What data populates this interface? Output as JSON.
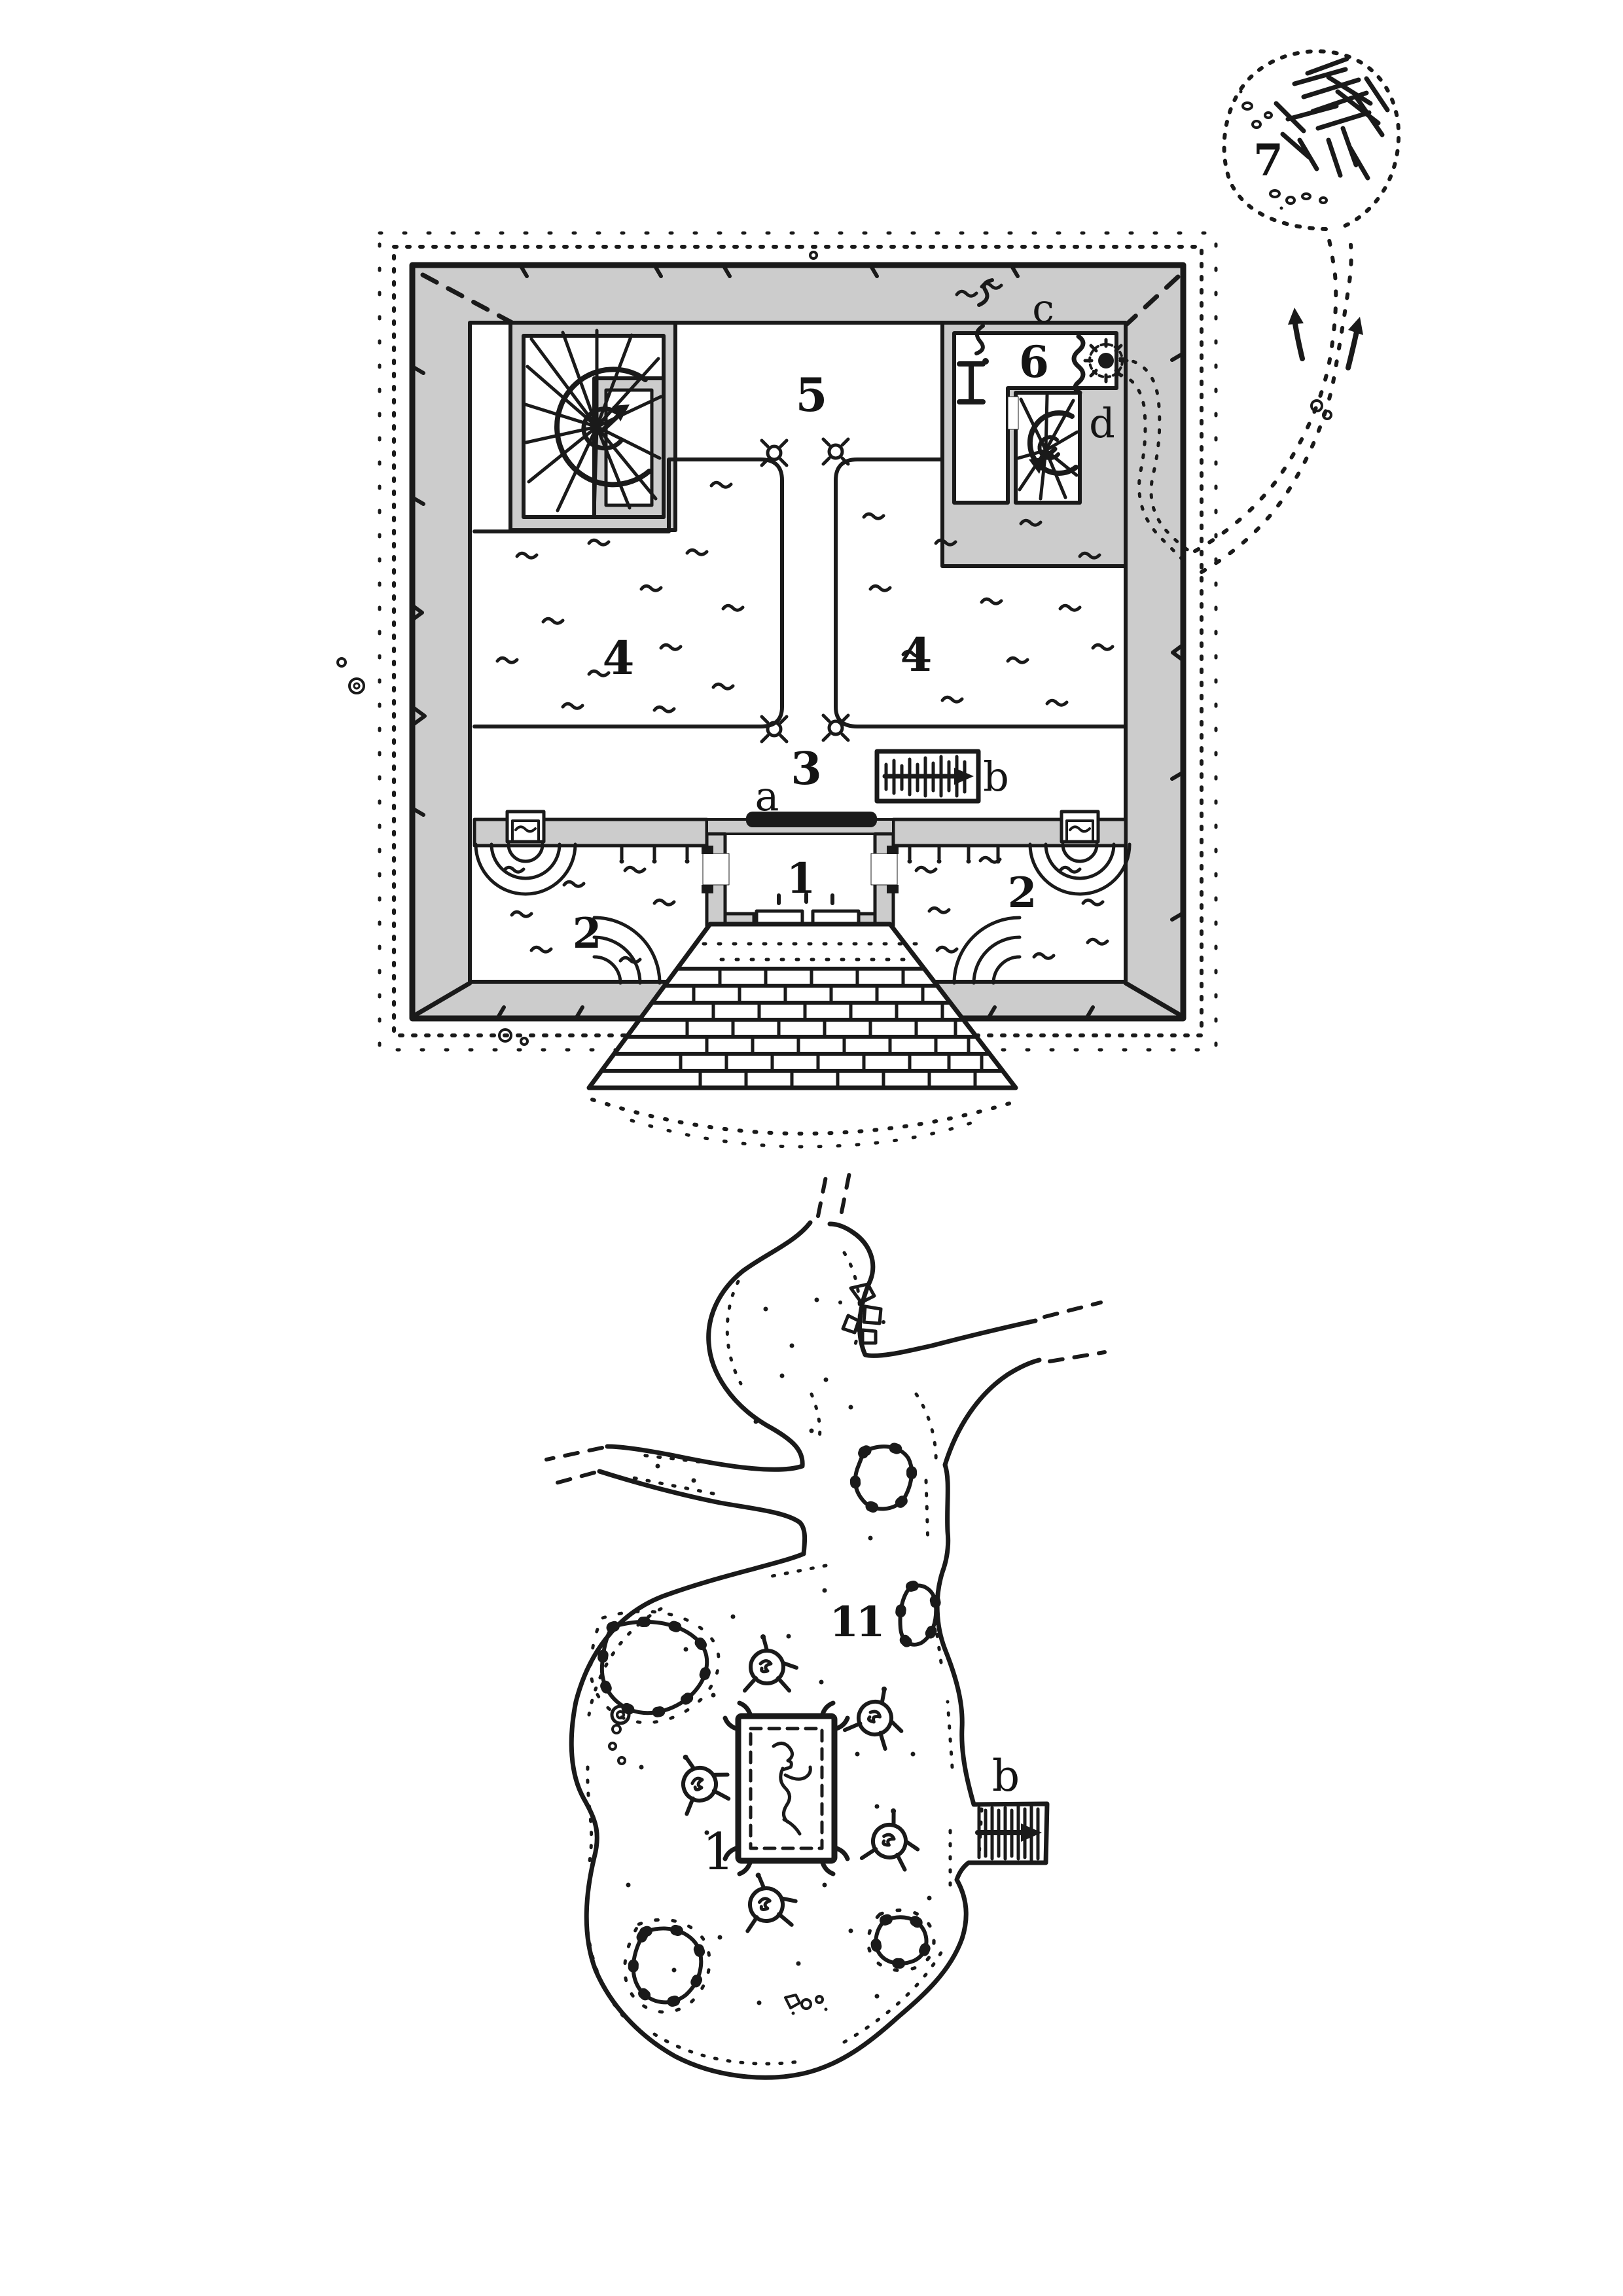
{
  "sheet": {
    "background": "#ffffff",
    "ink_color": "#1a1a1a",
    "wall_fill_color": "#cccccc",
    "boulder_fill_color": "#d6d6d6"
  },
  "temple_map": {
    "labels": {
      "room1": "1",
      "room2_left": "2",
      "room2_right": "2",
      "room3": "3",
      "room4_left": "4",
      "room4_right": "4",
      "room5": "5",
      "room6": "6",
      "cave7": "7",
      "feature_a": "a",
      "feature_b": "b",
      "feature_c": "c",
      "feature_d": "d"
    }
  },
  "cavern_map": {
    "labels": {
      "area": "11",
      "bier": "1",
      "feature_b": "b"
    }
  },
  "legend_symbols": {
    "spiral_stair": "spiral staircase with direction arrow",
    "sconce": "wall sconce at corridor corners",
    "fountain": "wall basin with ripple arcs",
    "stairs": "hatched stair passage with arrow",
    "slab": "black stone slab",
    "trail": "dotted outdoor trail",
    "creature": "round creature/nest with legs",
    "boulder": "shaded rock mass",
    "log_pile": "criss-crossed log pile"
  }
}
